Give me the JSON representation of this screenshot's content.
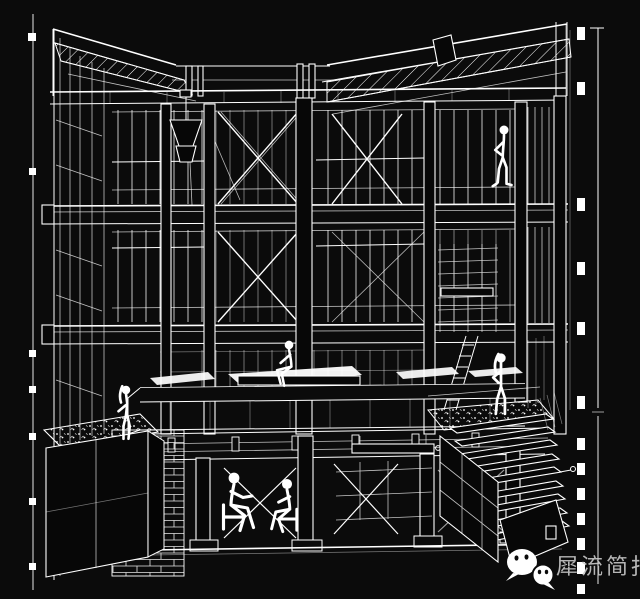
{
  "page": {
    "background_color": "#0b0b0b",
    "ink_color": "#ffffff",
    "content_kind": "architectural sectional perspective line drawing, white on black"
  },
  "watermark": {
    "text": "犀流简报",
    "text_color": "#c9c9c9",
    "icon": "wechat-icon",
    "icon_color": "#ffffff"
  }
}
